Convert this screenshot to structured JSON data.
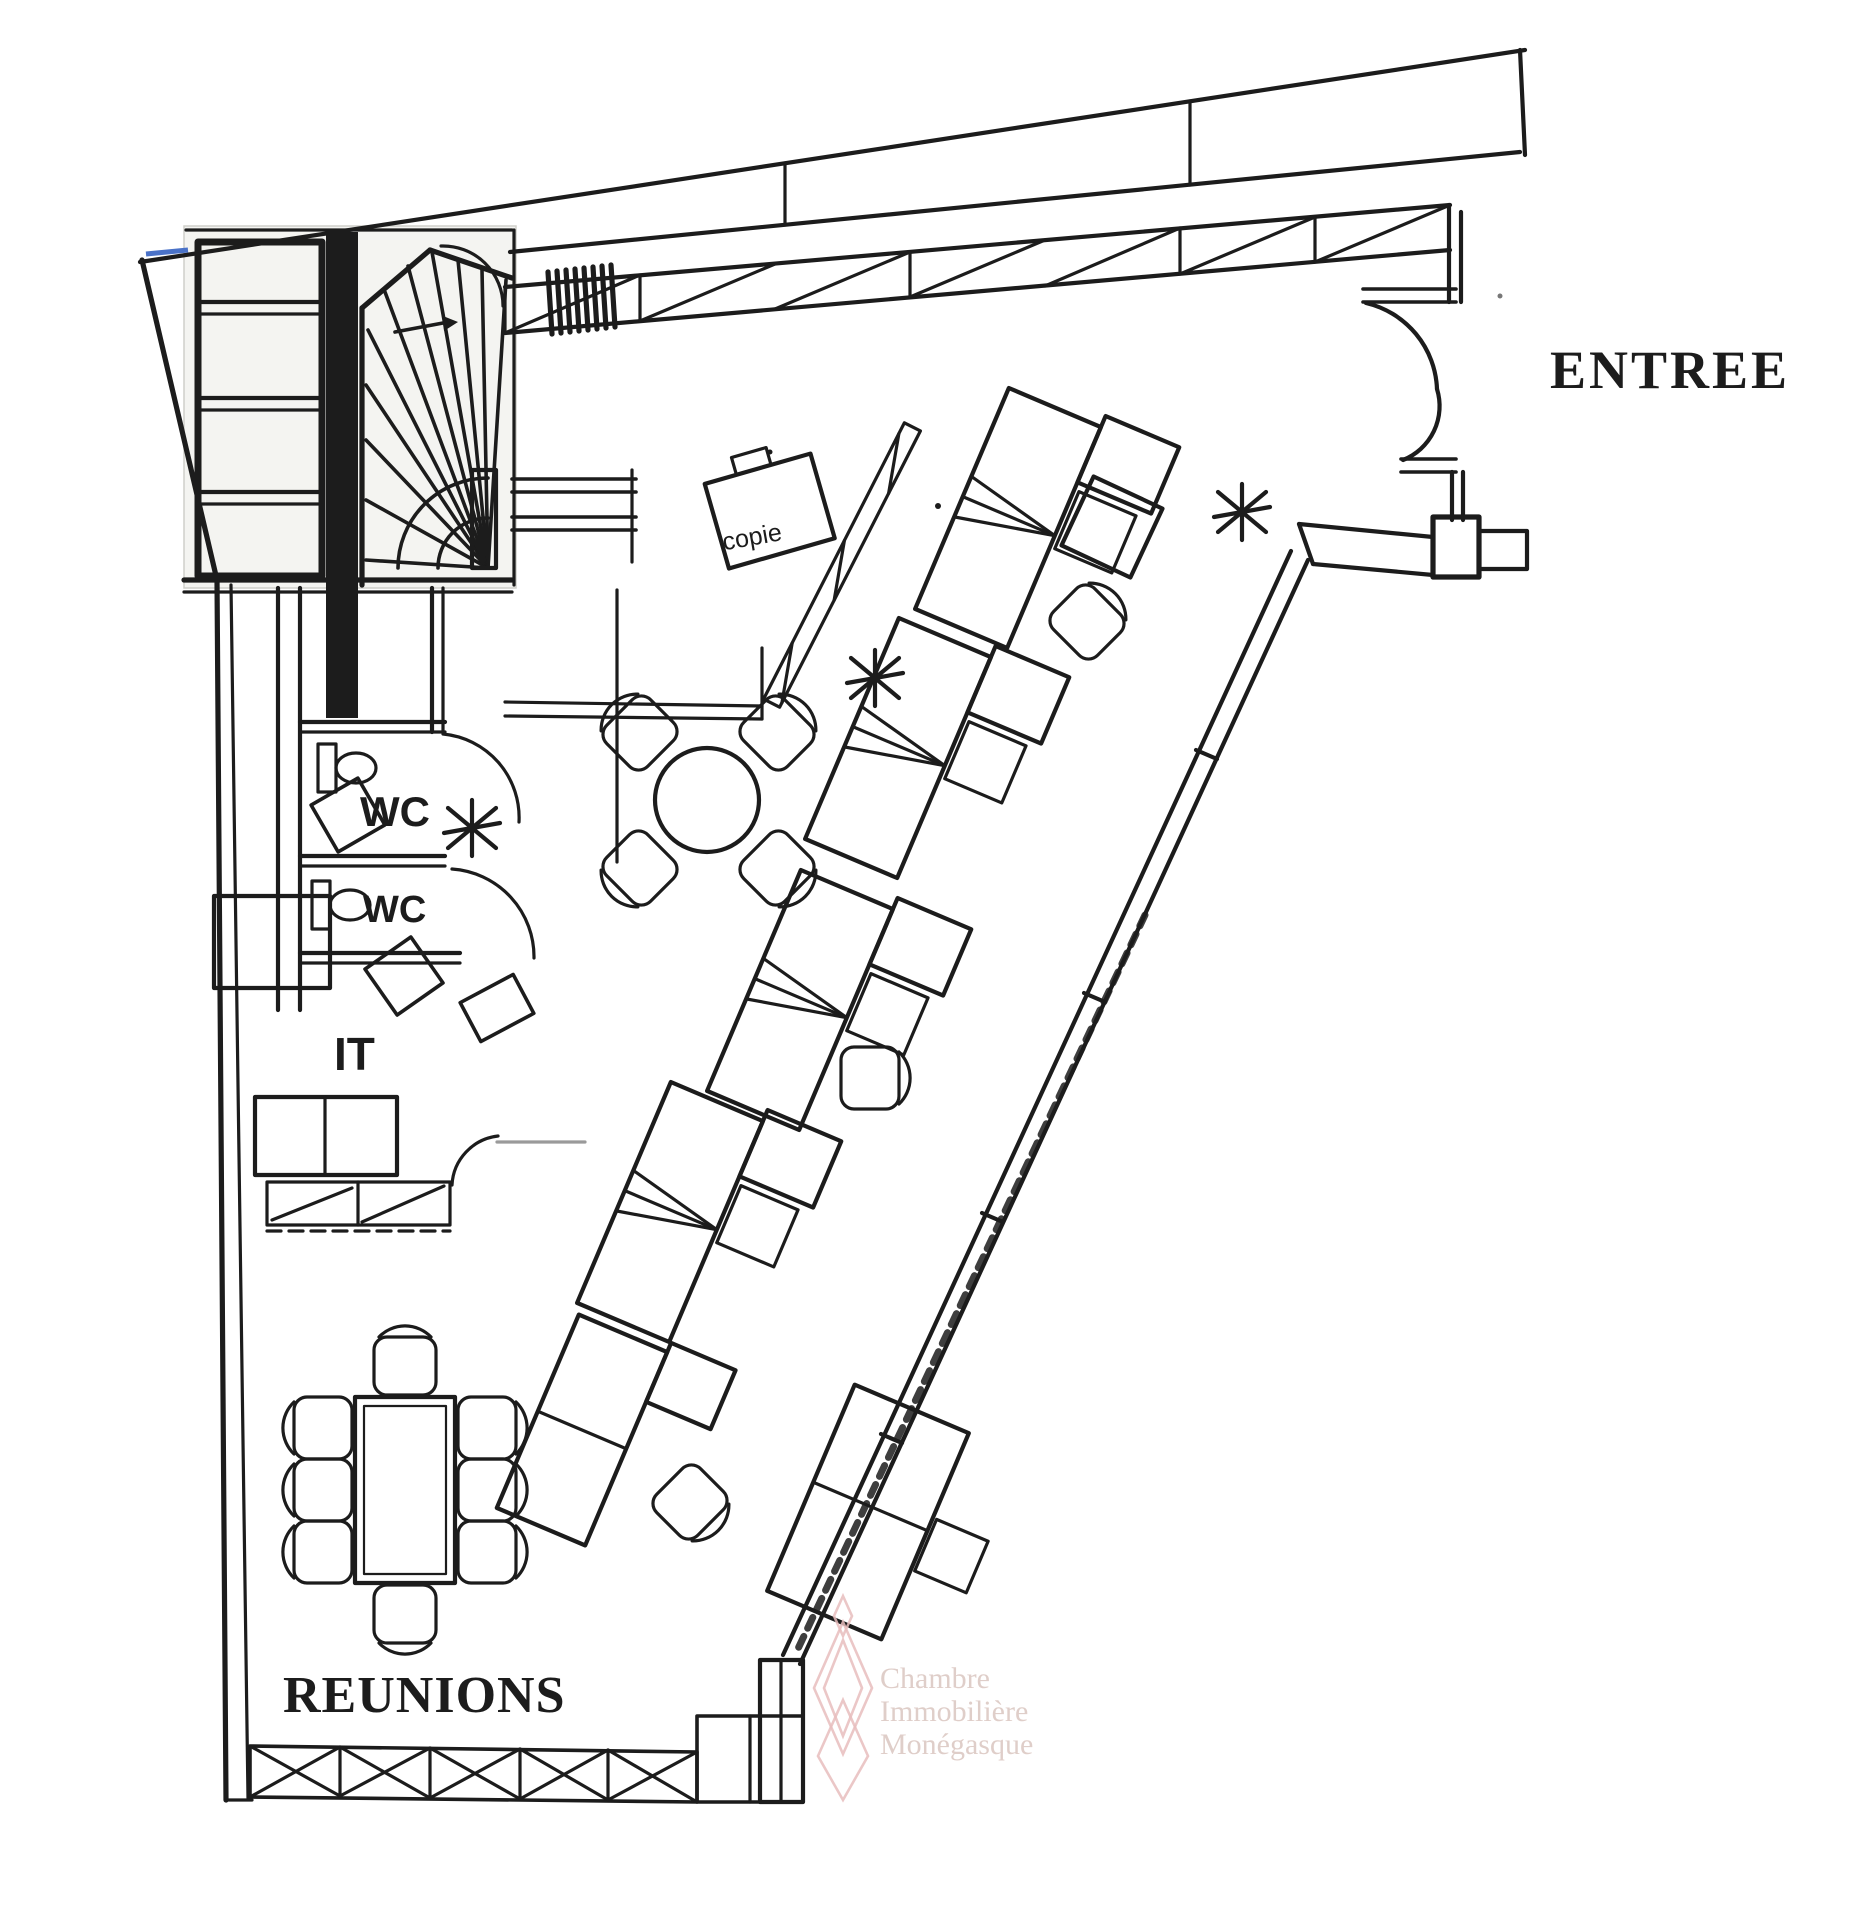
{
  "document": {
    "type": "scanned-office-floor-plan"
  },
  "labels": {
    "entrance": "ENTREE",
    "meeting_room": "REUNIONS",
    "wc_1": "WC",
    "wc_2": "WC",
    "it_room": "IT",
    "copier": "copie"
  },
  "watermark": {
    "line1": "Chambre",
    "line2": "Immobilière",
    "line3": "Monégasque",
    "logo": "diamond-chain-logo"
  },
  "icons": {
    "staircase": "spiral-staircase-icon",
    "toilet": "toilet-icon",
    "plant": "plant-icon",
    "chair": "office-chair-icon",
    "desk": "workstation-desk-icon",
    "door": "door-swing-icon"
  },
  "colors": {
    "ink": "#1c1c1c",
    "paper": "#ffffff",
    "inset_bg": "#f4f4f1",
    "blue_mark": "#4a72c8",
    "watermark_logo": "#e8bdbd",
    "watermark_text": "#d8c2bc",
    "faint_line": "#9a9a9a"
  }
}
